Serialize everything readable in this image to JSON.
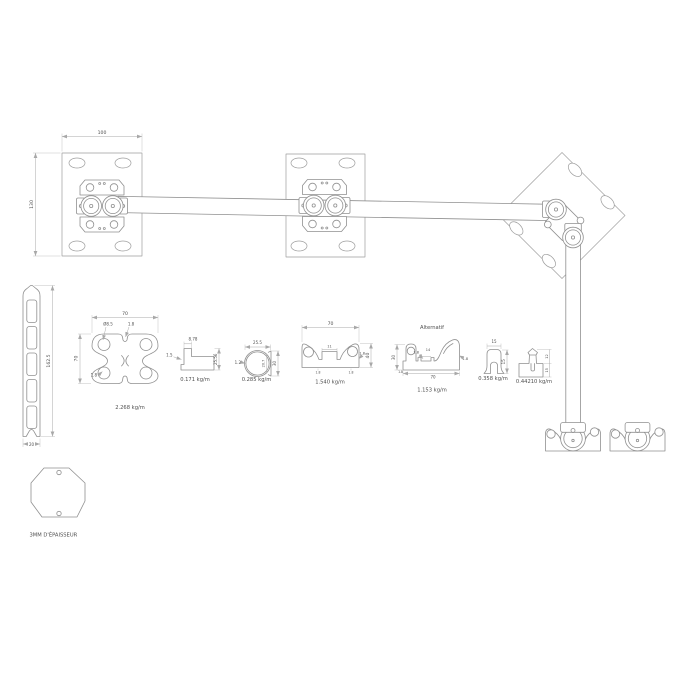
{
  "drawing": {
    "line_color": "#909090",
    "dim_color": "#a8a8a8",
    "text_color": "#4f4f4f"
  },
  "assembly": {
    "plate_width_dim": "100",
    "plate_height_dim": "130"
  },
  "post": {
    "height_dim": "162.5",
    "width_dim": "20"
  },
  "sections": {
    "butterfly": {
      "width_dim": "70",
      "height_dim": "70",
      "hole_dim": "Ø8.5",
      "wall_top_dim": "1.8",
      "wall_bottom_dim": "1.8",
      "weight": "2.268 kg/m"
    },
    "angle": {
      "width_dim": "8.78",
      "thickness_dim": "1.5",
      "height_dim": "25.56",
      "weight": "0.171 kg/m"
    },
    "tube": {
      "width_dim": "25.5",
      "wall_dim": "1.2",
      "inner_dim": "20.7",
      "height_dim": "30",
      "weight": "0.285 kg/m"
    },
    "rail": {
      "width_dim": "70",
      "height_dim": "40",
      "slot_dim": "11",
      "wall_dim": "1.8",
      "foot_left_dim": "1.8",
      "foot_right_dim": "1.8",
      "weight": "1.540 kg/m"
    },
    "alternatif": {
      "title": "Alternatif",
      "height_dim": "30",
      "lip_wall_dim": "1.8",
      "slot_dim": "14",
      "width_dim": "70",
      "claw_wall_dim": "1.8",
      "foot_dim": "1.8",
      "weight": "1.153 kg/m"
    },
    "uclip": {
      "width_dim": "15",
      "height_dim": "15",
      "weight": "0.358 kg/m"
    },
    "hook": {
      "upper_dim": "12",
      "lower_dim": "15",
      "weight": "0.44210 kg/m"
    }
  },
  "gusset": {
    "note": "3MM D'ÉPAISSEUR"
  }
}
